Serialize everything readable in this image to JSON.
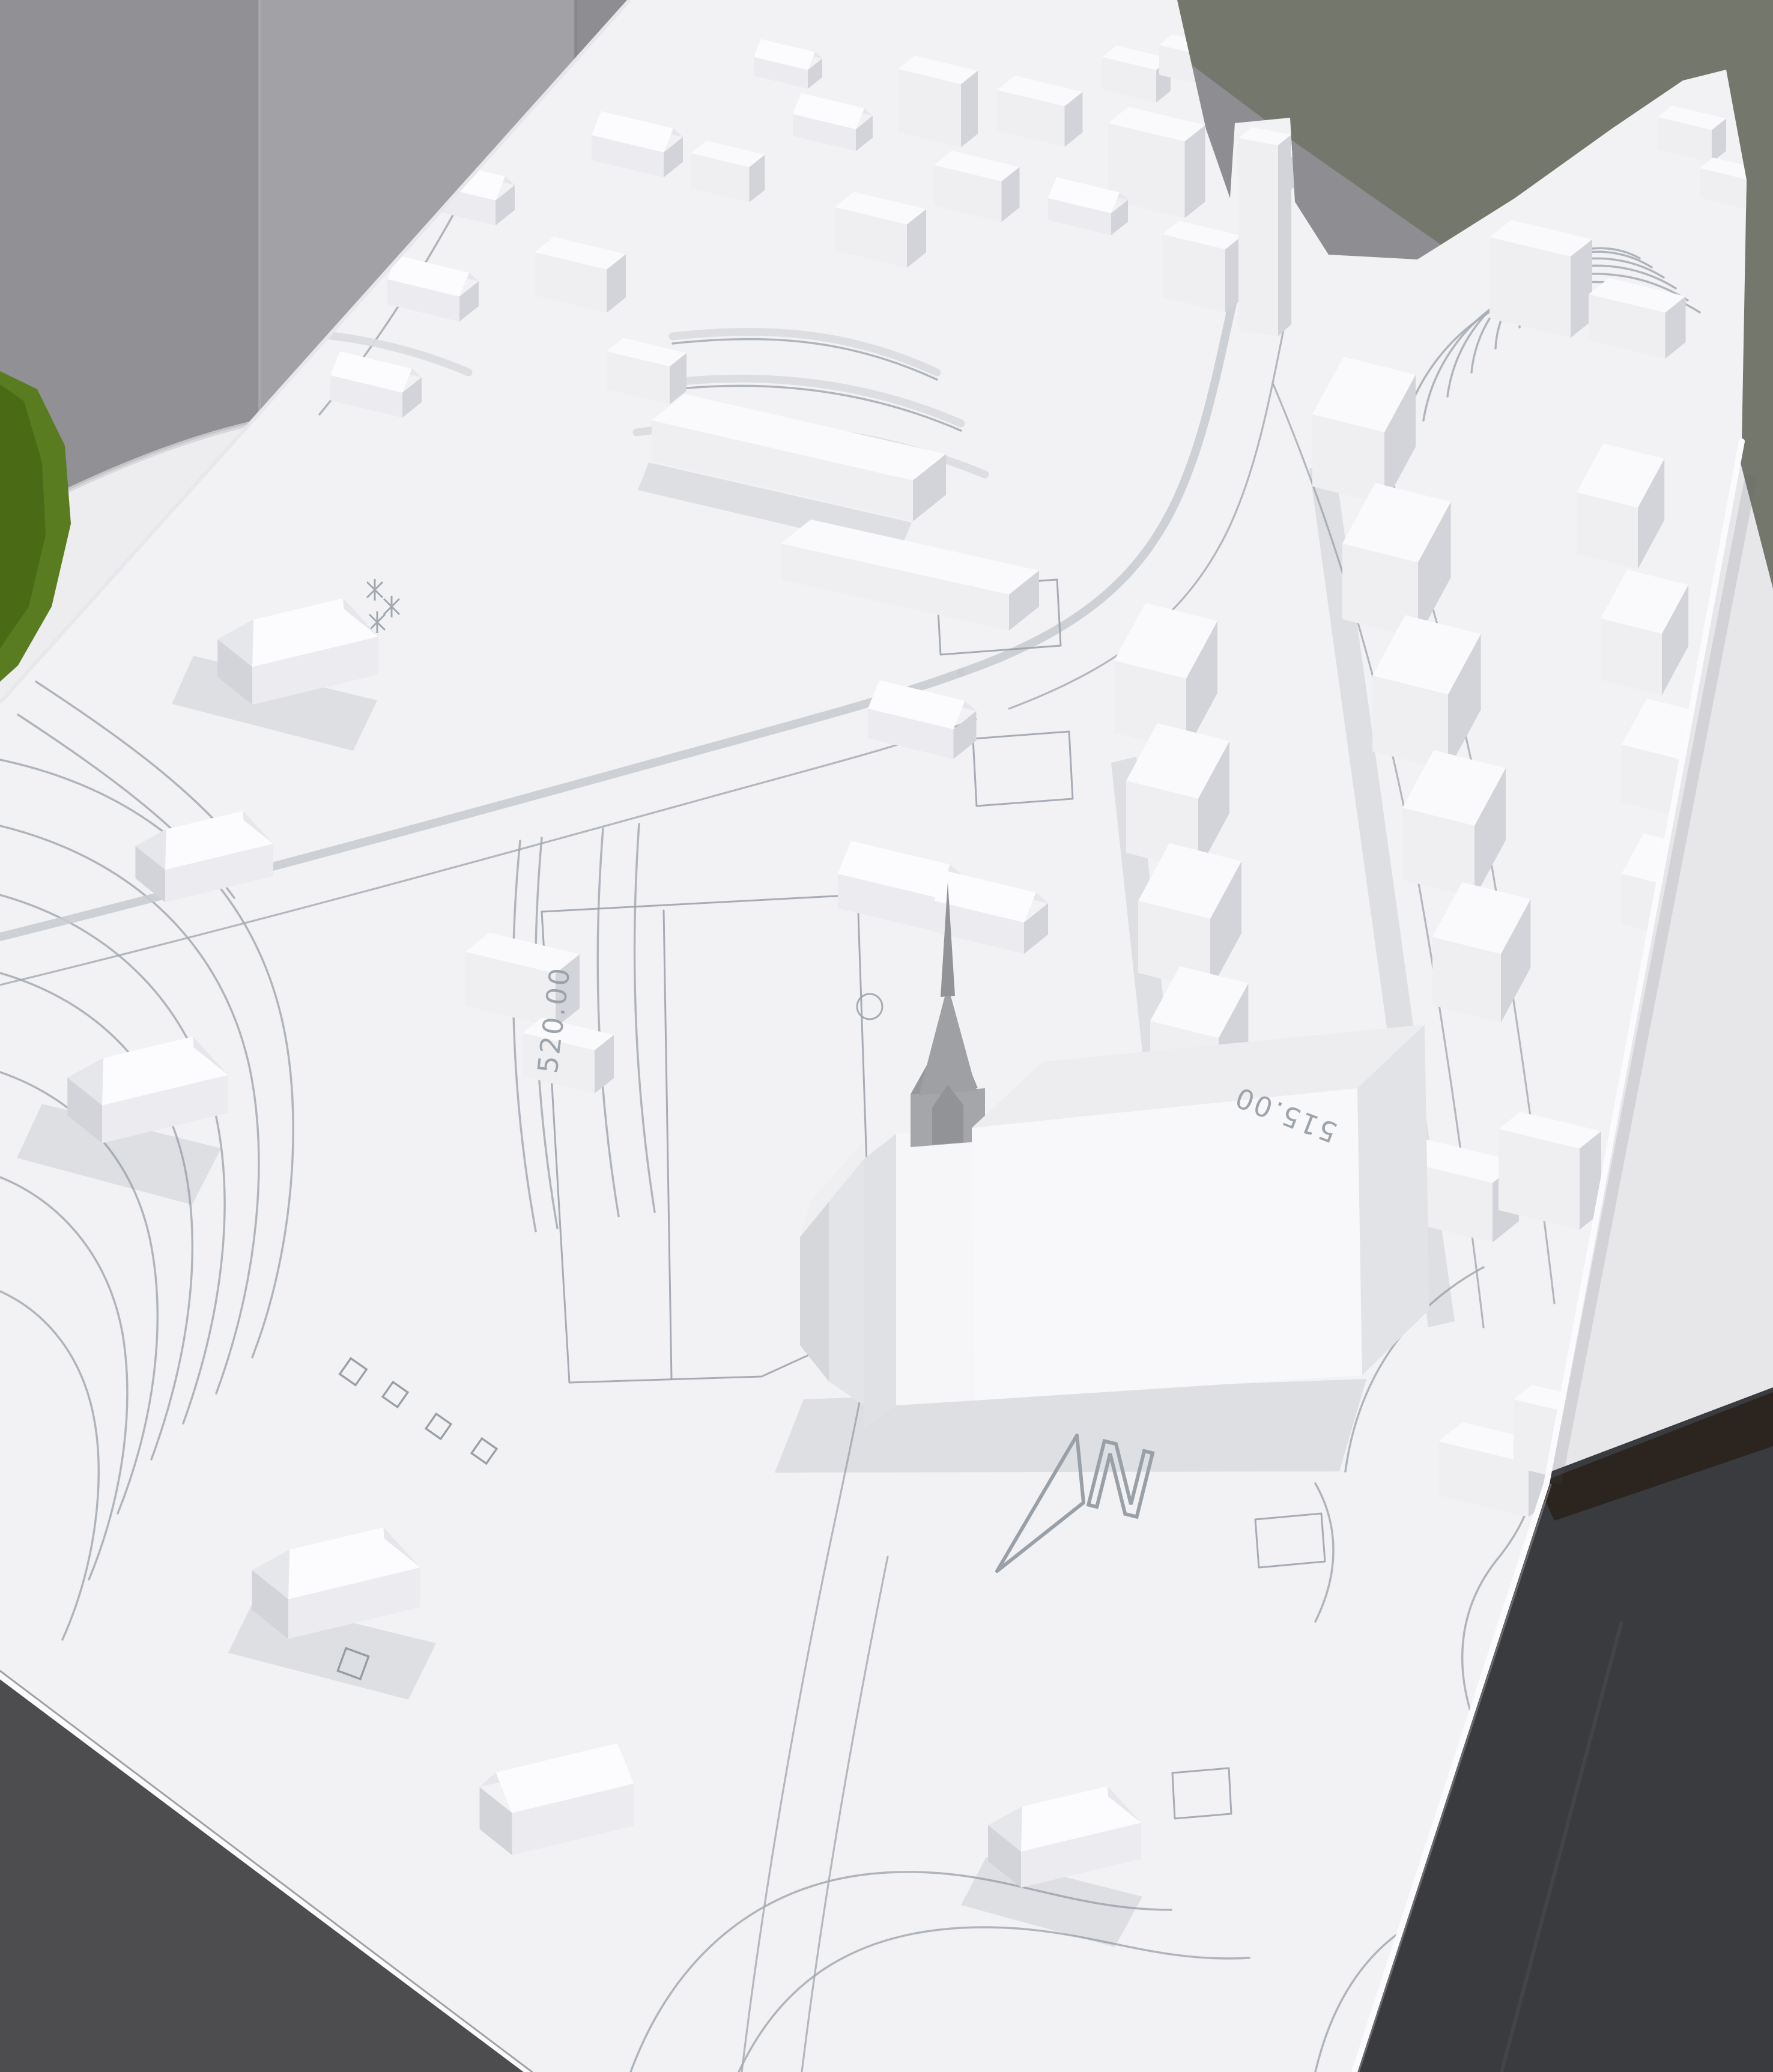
{
  "labels": {
    "elevation_plateau": "520.00",
    "elevation_right": "515.00",
    "elevation_bottom_left": "515.00",
    "north_letter": "N"
  },
  "colors": {
    "wall": "#919095",
    "wall_light_strip": "#a2a1a6",
    "wall_olive": "#74786c",
    "green_object": "#5a7c20",
    "green_object_dark": "#4a6a16",
    "table": "#ededf0",
    "table_right": "#e7e7ea",
    "table_edge_band": "#2b241f",
    "floor_left": "#4d4d50",
    "floor_right": "#3a3b3e",
    "model_board": "#f2f2f5",
    "engraving": "#a9aeb6",
    "building_top": "#fafafc",
    "building_front": "#efeff2",
    "building_side": "#d3d4d9",
    "roof_bright": "#fcfcfe",
    "roof_shade": "#e6e7eb",
    "church_spire": "#a5a6aa",
    "church_nave_front": "#f8f8fa",
    "shadow": "#878c96"
  }
}
